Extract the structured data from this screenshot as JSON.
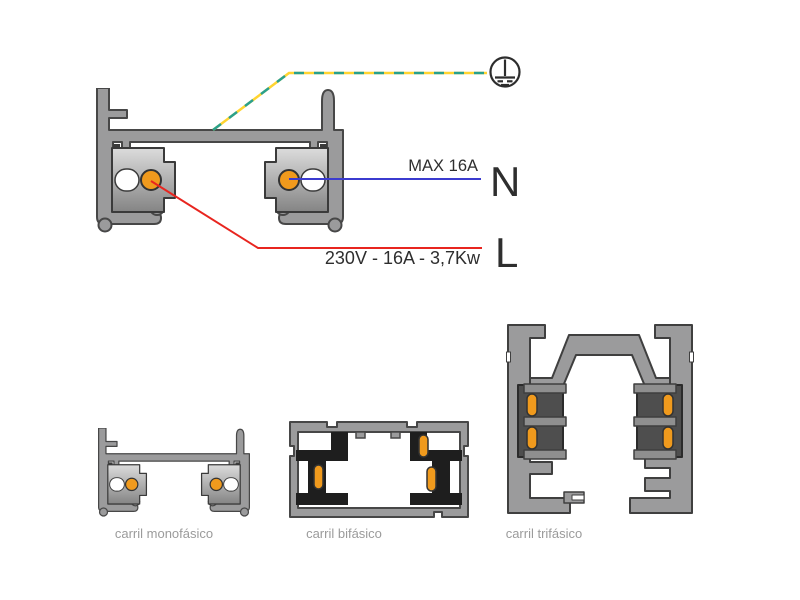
{
  "figure": {
    "background": "#ffffff",
    "main_diagram": {
      "description": "single-phase lighting track cross-section with wiring annotations",
      "labels": {
        "max_current": "MAX 16A",
        "neutral_symbol": "N",
        "line_symbol": "L",
        "power_spec": "230V - 16A - 3,7Kw"
      },
      "wires": {
        "earth": {
          "style": "dashed",
          "colors": [
            "#2aa08c",
            "#ffd431"
          ]
        },
        "neutral": {
          "color": "#3b3bcf"
        },
        "line": {
          "color": "#e8251f"
        }
      },
      "ground_icon": "protective-earth-symbol"
    },
    "rail_colors": {
      "body": "#9b9b9c",
      "outline": "#474747",
      "insulator_black": "#1e1e1e",
      "holder_dark": "#4e4e4e",
      "conductor_orange": "#f09a1d",
      "caption_grey": "#9b9b9b",
      "text_dark": "#2e2e2e"
    },
    "captions": [
      {
        "label": "carril monofásico"
      },
      {
        "label": "carril bifásico"
      },
      {
        "label": "carril trifásico"
      }
    ]
  }
}
